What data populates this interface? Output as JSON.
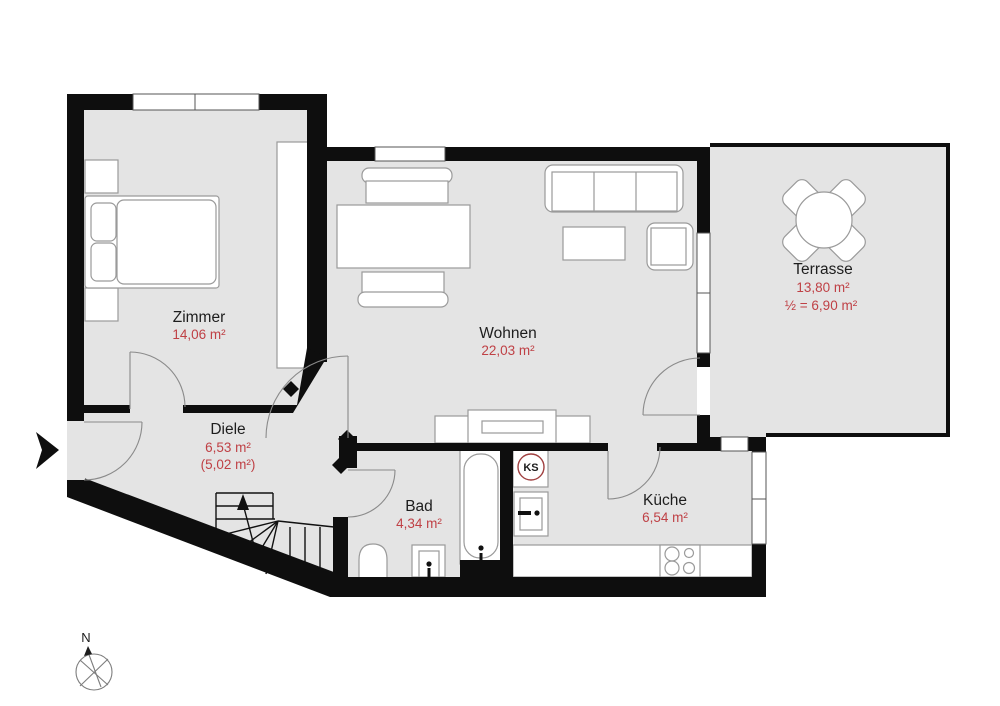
{
  "plan": {
    "rooms": {
      "zimmer": {
        "label": "Zimmer",
        "area": "14,06 m²"
      },
      "wohnen": {
        "label": "Wohnen",
        "area": "22,03 m²"
      },
      "terrasse": {
        "label": "Terrasse",
        "area": "13,80 m²",
        "half_area": "½ = 6,90 m²"
      },
      "diele": {
        "label": "Diele",
        "area": "6,53 m²",
        "secondary_area": "(5,02 m²)"
      },
      "bad": {
        "label": "Bad",
        "area": "4,34 m²"
      },
      "kueche": {
        "label": "Küche",
        "area": "6,54 m²"
      }
    },
    "markers": {
      "fridge": "KS",
      "compass_north": "N"
    },
    "colors": {
      "wall": "#0e0e0e",
      "floor": "#e4e4e4",
      "accent_red": "#bf4045",
      "furniture_stroke": "#9a9a9a",
      "fridge_ring": "#a04040"
    }
  }
}
